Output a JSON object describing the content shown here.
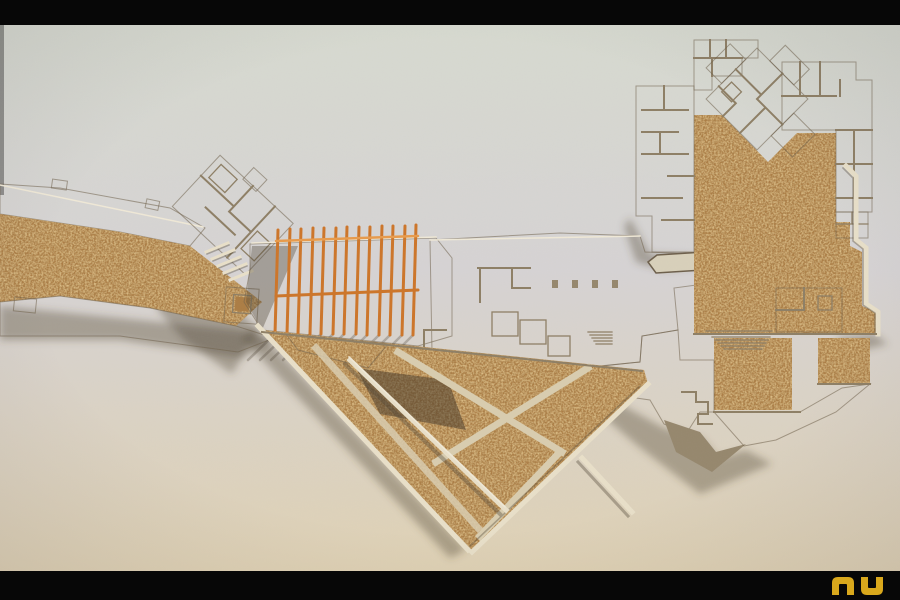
{
  "meta": {
    "kind": "photograph",
    "subject": "Architectural site model viewed from above",
    "materials": "grey-tan cardboard plates and walls, speckled cork ground areas, orange wooden pergola fins",
    "framing": "black letterbox bars across the top and bottom of the photo"
  },
  "palette": {
    "letterbox": "#070707",
    "bg_top": "#d7dad0",
    "bg_mid": "#d6d3d4",
    "bg_bottom": "#e0d2b4",
    "board_light": "#c9bda2",
    "board_mid": "#b3a78c",
    "board_pale": "#d8d0ba",
    "board_dark": "#95866c",
    "wall_dark": "#8d7e64",
    "wall_hi": "#f0e9d7",
    "cream": "#e9e0c9",
    "path": "#d9cdaf",
    "cork": "#ab7c42",
    "cork_dark": "#6e5c45",
    "orange": "#cd7427",
    "orange_light": "#e89a4a",
    "shadow": "rgba(80,68,52,0.38)",
    "shadow_deep": "rgba(62,50,36,0.5)",
    "logo": "#d9a81c"
  },
  "logo": {
    "text": "nu"
  },
  "scene": {
    "regions": [
      {
        "name": "left-walkway",
        "material": "cork path flanked by pale cardboard banks, entering from left edge"
      },
      {
        "name": "entry-cluster",
        "material": "diagonal cardboard rooms, upper left"
      },
      {
        "name": "square-pavilion",
        "material": "small square pavilion with dark cork core"
      },
      {
        "name": "pergola",
        "material": "row of 13 vertical orange fins casting diagonal shadows"
      },
      {
        "name": "main-hall-plate",
        "material": "central flat cardboard plate with low relief room walls, columns and stairs"
      },
      {
        "name": "garden-triangle",
        "material": "large triangular cork garden with pale diagonal paths and a raised cream wall, apex at bottom"
      },
      {
        "name": "north-east-complex",
        "material": "U-shaped wings of rooms around cork courtyards with a 45-degree rotated pavilion"
      },
      {
        "name": "east-cork-field",
        "material": "large cork field bounded by a stepped cream retaining wall"
      },
      {
        "name": "south-east-terraces",
        "material": "stepped terraces, stairs and zigzag walls over cork patches"
      }
    ]
  }
}
